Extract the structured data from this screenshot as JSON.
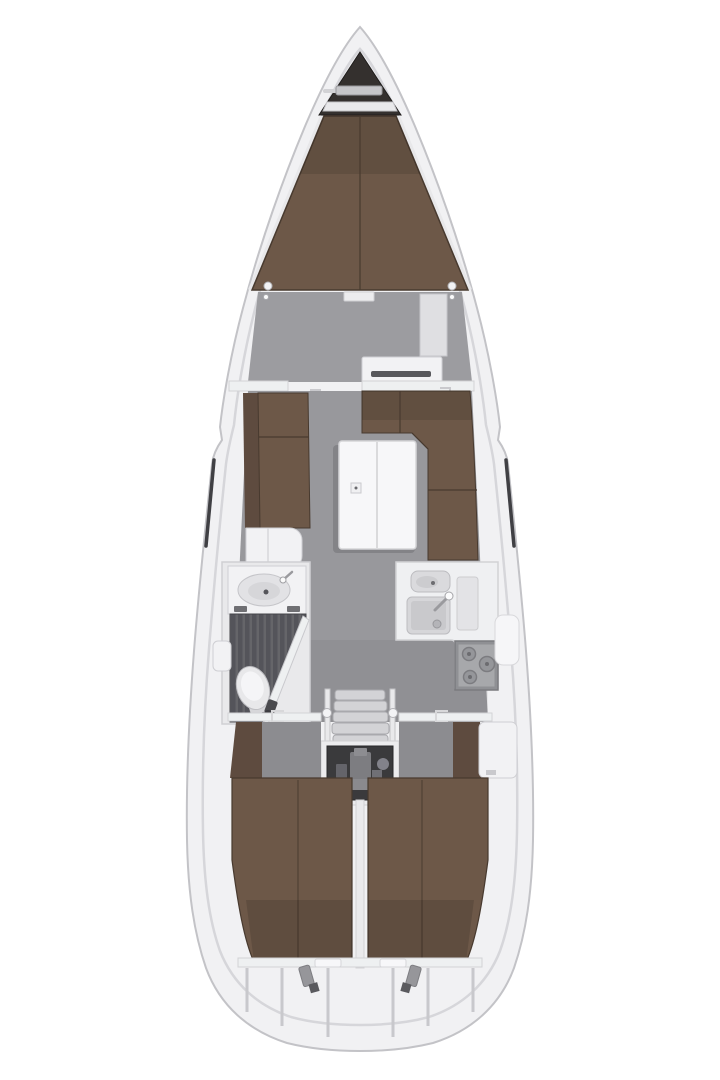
{
  "meta": {
    "title": "Sailing yacht interior layout plan, top-down view, bow up",
    "type": "boat-floor-plan"
  },
  "canvas": {
    "width": 720,
    "height": 1080,
    "background": "#ffffff"
  },
  "colors": {
    "hull": "#f1f1f3",
    "hull_outline": "#c3c3c7",
    "deck_line": "#d6d6da",
    "anchor_locker": "#34302e",
    "windlass": "#c6c6c9",
    "upholstery": "#6d5848",
    "upholstery_dark": "#5e4b3f",
    "upholstery_edge": "#483a2f",
    "floor_fwd": "#9c9ca0",
    "floor_salon": "#98989c",
    "floor_aft": "#8c8c90",
    "fixture": "#f2f2f4",
    "fixture_outline": "#cfcfd3",
    "sink_basin": "#d6d6d9",
    "shower_floor": "#54545a",
    "shower_slat": "#656569",
    "stove_panel": "#a7a8ab",
    "burner": "#95969a",
    "engine_bay": "#3a3a3c",
    "engine_metal": "#7d7d81",
    "step_tread": "#d3d3d6",
    "window": "#404044",
    "shadow": "rgba(40,40,45,0.18)"
  },
  "areas": {
    "hull": "hull and side decks",
    "bow_locker": "bow anchor locker with windlass",
    "forward_cabin": "forward cabin with V-berth",
    "salon": "salon with settees and folding table",
    "head": "head with wash basin, shower grating and toilet",
    "galley": "galley with double sink and stove",
    "companionway": "companionway steps",
    "engine": "engine compartment",
    "aft_cabin_port": "port aft double cabin",
    "aft_cabin_starboard": "starboard aft double cabin",
    "stern": "stern lazarette and steering gear"
  }
}
